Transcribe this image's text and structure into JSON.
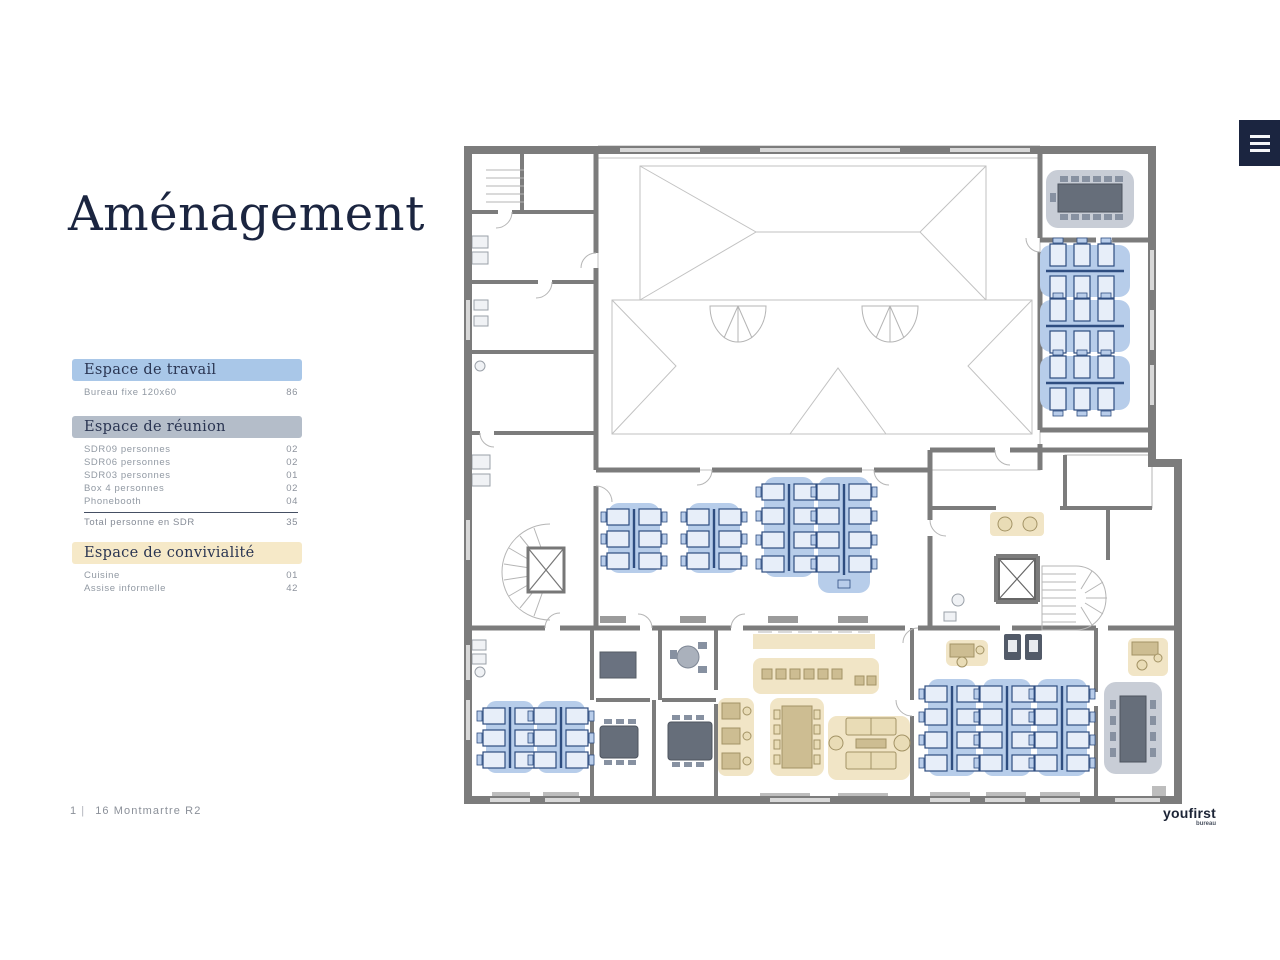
{
  "page": {
    "title": "Aménagement"
  },
  "menu": {
    "icon": "hamburger-menu"
  },
  "footer": {
    "page": "1",
    "sep": "|",
    "label": "16 Montmartre R2"
  },
  "logo": {
    "brand": "youfirst",
    "sub": "bureau"
  },
  "legend": {
    "sections": [
      {
        "title": "Espace de travail",
        "rows": [
          {
            "label": "Bureau fixe 120x60",
            "value": "86"
          }
        ]
      },
      {
        "title": "Espace de réunion",
        "rows": [
          {
            "label": "SDR09 personnes",
            "value": "02"
          },
          {
            "label": "SDR06 personnes",
            "value": "02"
          },
          {
            "label": "SDR03 personnes",
            "value": "01"
          },
          {
            "label": "Box 4 personnes",
            "value": "02"
          },
          {
            "label": "Phonebooth",
            "value": "04"
          }
        ],
        "total": {
          "label": "Total personne en SDR",
          "value": "35"
        }
      },
      {
        "title": "Espace de convivialité",
        "rows": [
          {
            "label": "Cuisine",
            "value": "01"
          },
          {
            "label": "Assise informelle",
            "value": "42"
          }
        ]
      }
    ]
  },
  "floorplan": {
    "name": "Plan d'aménagement 16 Montmartre R2"
  },
  "colors": {
    "navy": "#1b2540",
    "header-travail": "#a9c7e8",
    "header-reunion": "#b4bdc9",
    "header-convivialite": "#f6e9c8",
    "label-gray": "#9199a3",
    "wall-gray": "#7c7c7c",
    "zone-blue": "#b7cdea",
    "desk-navy": "#2e4d80",
    "zone-cream": "#f1e5c6",
    "furniture-tan": "#cdbd92",
    "zone-gray": "#c8cdd6",
    "table-gray": "#666e7a"
  }
}
